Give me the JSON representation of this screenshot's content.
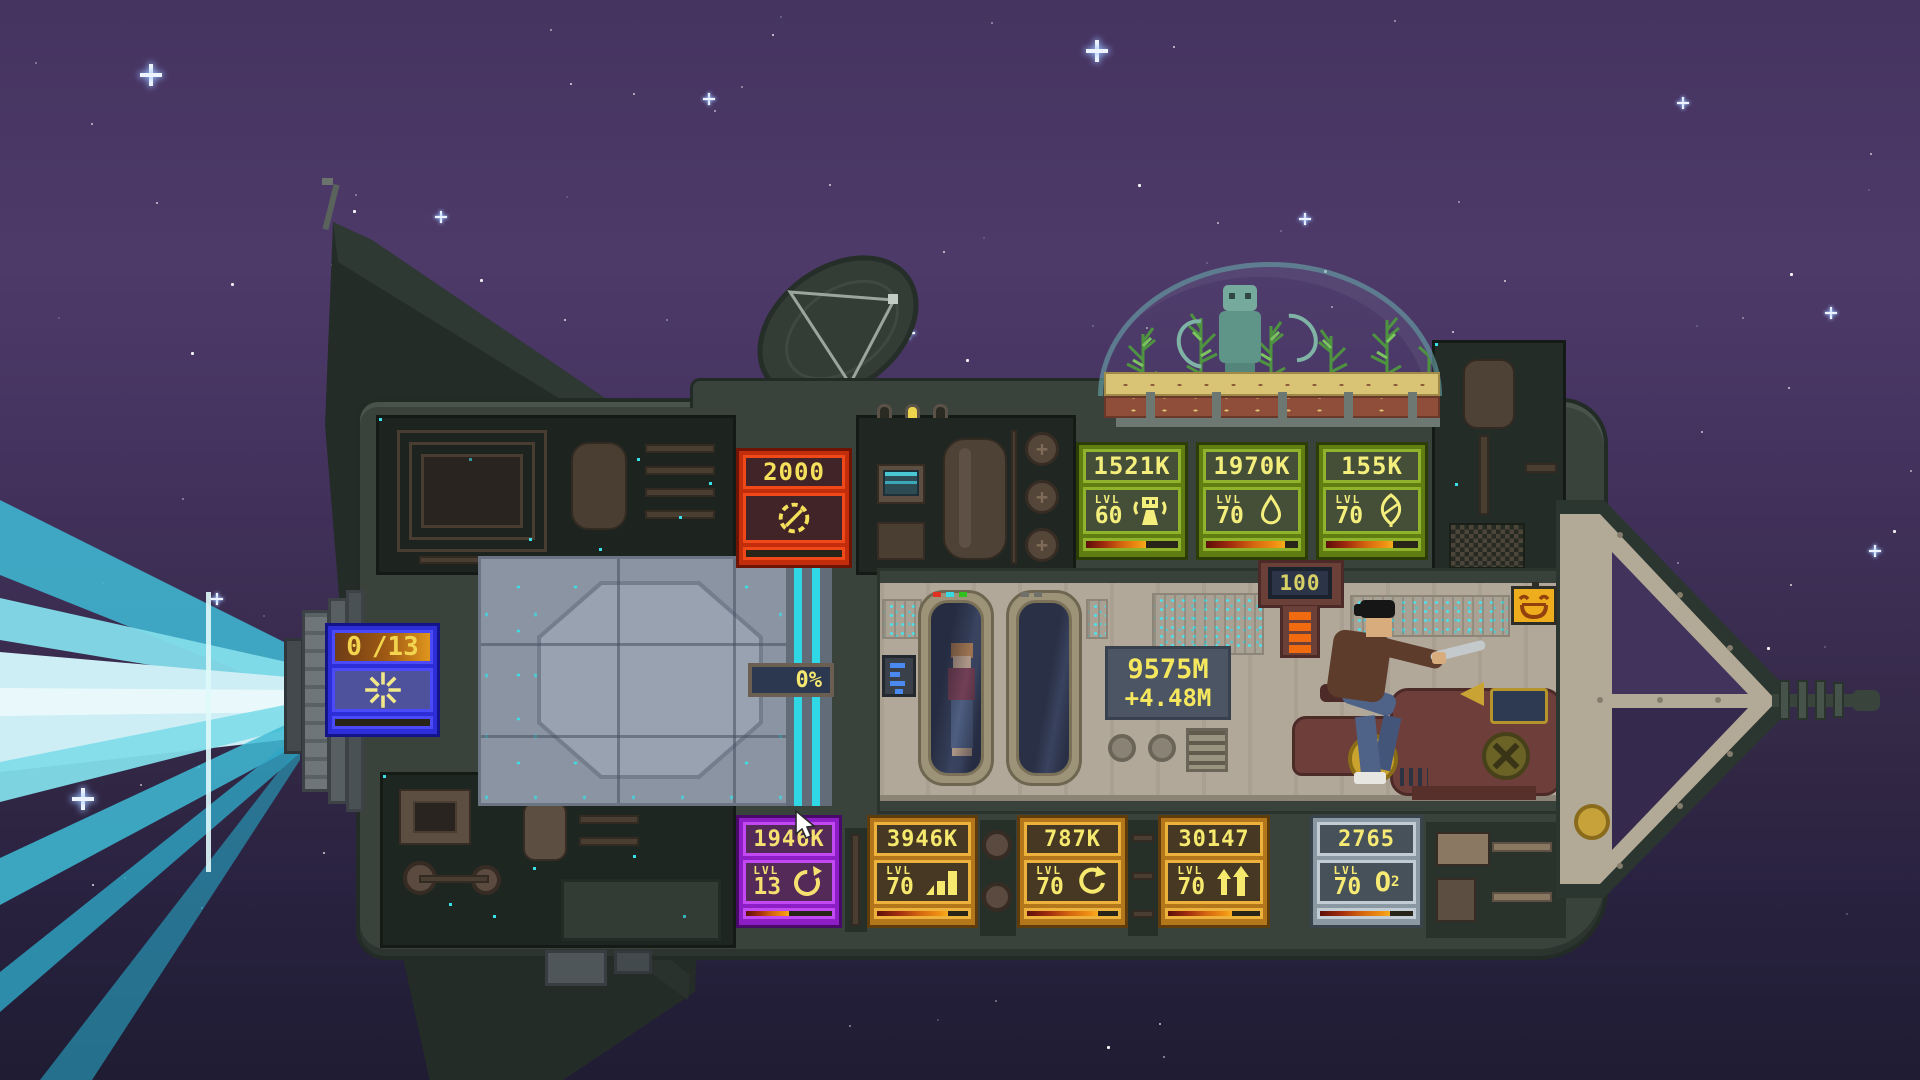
{
  "scene": {
    "description": "pixel-art spaceship cutaway flying left with engine beams, greenhouse dome, crew rooms and upgrade panels"
  },
  "counter": {
    "total": "9575M",
    "rate": "+4.48M"
  },
  "badges": {
    "efficiency": "0%",
    "crew_top": "100"
  },
  "panels": {
    "engine": {
      "current": "0",
      "capacity": "/13",
      "progress": 0
    },
    "fuel": {
      "value": "2000",
      "progress": 0
    },
    "top": [
      {
        "value": "1521K",
        "lvl_label": "LVL",
        "level": "60",
        "icon": "robot-icon",
        "progress": 65
      },
      {
        "value": "1970K",
        "lvl_label": "LVL",
        "level": "70",
        "icon": "droplet-icon",
        "progress": 86
      },
      {
        "value": "155K",
        "lvl_label": "LVL",
        "level": "70",
        "icon": "leaf-icon",
        "progress": 73
      }
    ],
    "bottom": [
      {
        "value": "1946K",
        "lvl_label": "LVL",
        "level": "13",
        "icon": "rotate-icon",
        "progress": 50
      },
      {
        "value": "3946K",
        "lvl_label": "LVL",
        "level": "70",
        "icon": "signal-bars-icon",
        "progress": 78
      },
      {
        "value": "787K",
        "lvl_label": "LVL",
        "level": "70",
        "icon": "refresh-icon",
        "progress": 78
      },
      {
        "value": "30147",
        "lvl_label": "LVL",
        "level": "70",
        "icon": "crew-arrows-icon",
        "progress": 70
      },
      {
        "value": "2765",
        "lvl_label": "LVL",
        "level": "70",
        "icon": "oxygen-icon",
        "icon_text": "O",
        "icon_sub": "2",
        "progress": 75
      }
    ]
  },
  "colors": {
    "accent_cyan": "#3ae0e8",
    "beam_light": "#cdeef5",
    "text_yellow": "#f6e96b",
    "panel_green": "#8fb32a",
    "panel_orange": "#ecb23c",
    "panel_purple": "#c148f2",
    "panel_red": "#f04818",
    "panel_blue": "#4a4af8",
    "panel_silver": "#c2ccd4"
  }
}
